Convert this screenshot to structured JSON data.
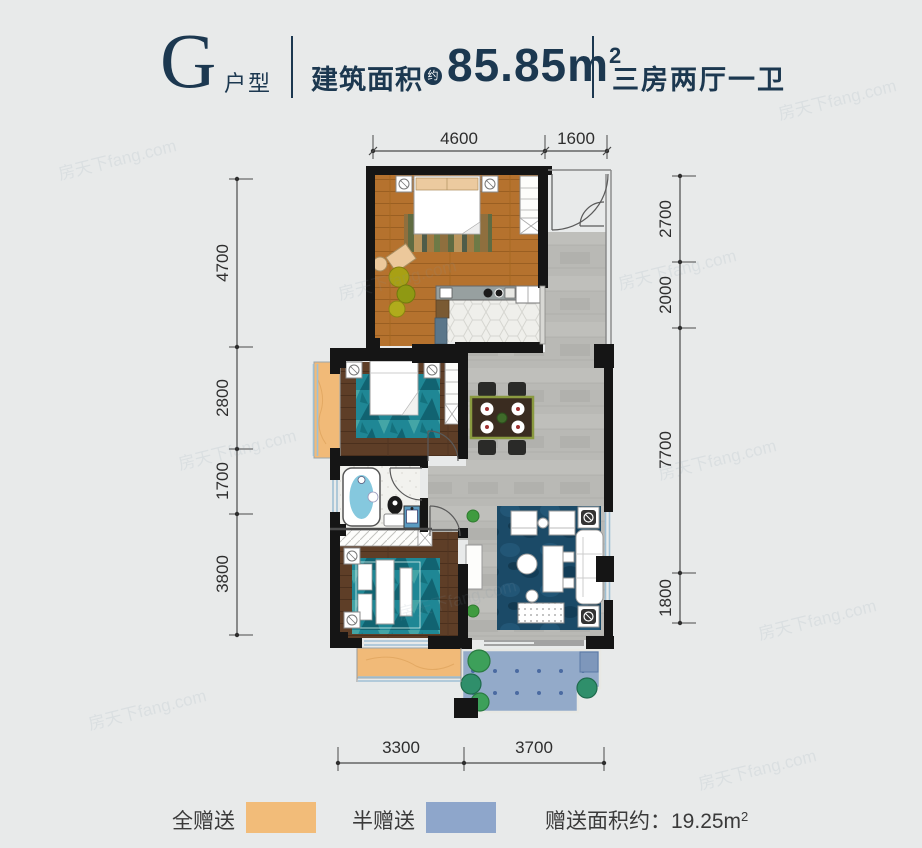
{
  "header": {
    "unit": "G",
    "unit_type_label": "户型",
    "area_label": "建筑面积",
    "area_approx_badge": "约",
    "area_value": "85.85m",
    "area_superscript": "2",
    "rooms_label": "三房两厅一卫"
  },
  "dimensions": {
    "top": [
      "4600",
      "1600"
    ],
    "left": [
      "4700",
      "2800",
      "1700",
      "3800"
    ],
    "right": [
      "2700",
      "2000",
      "7700",
      "1800"
    ],
    "bottom": [
      "3300",
      "3700"
    ]
  },
  "legend": {
    "full_gift": {
      "label": "全赠送",
      "color": "#f2bc79"
    },
    "half_gift": {
      "label": "半赠送",
      "color": "#8ea6cb"
    },
    "gift_area_label": "赠送面积约：",
    "gift_area_value": "19.25m",
    "gift_area_superscript": "2"
  },
  "watermark": "房天下fang.com",
  "colors": {
    "accent_navy": "#1c3850",
    "wall": "#151515",
    "wood_light": "#b5722e",
    "wood_dark": "#5e3e27",
    "tile_gray": "#b8b8b4",
    "balcony_full_gift": "#f1ba78",
    "balcony_half_gift": "#93aac9",
    "rug_teal": "#1f8795",
    "rug_living": "#1b4a67"
  }
}
